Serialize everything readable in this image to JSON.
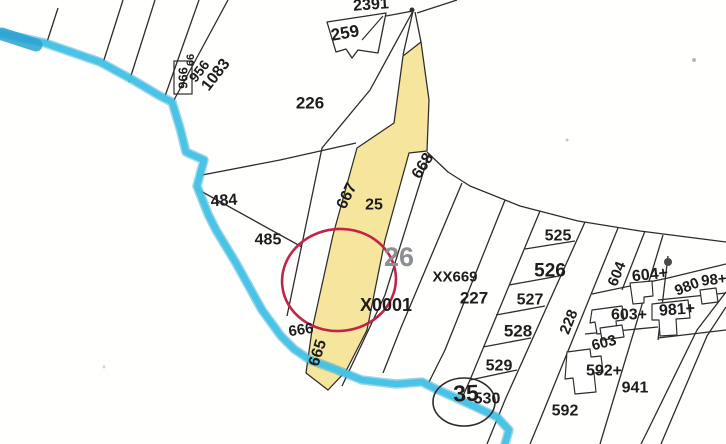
{
  "canvas": {
    "width": 726,
    "height": 444,
    "background": "#fffffe"
  },
  "colors": {
    "line": "#2e2c28",
    "text": "#1d1d1b",
    "muted": "#8d9092",
    "water": "#45c3e6",
    "water_dark": "#2aa2d0",
    "road_fill": "#f6e59d",
    "highlight": "#c02448",
    "white": "#ffffff"
  },
  "map": {
    "road_parcel": {
      "name": "road-parcel-25-highlight",
      "points": [
        [
          421,
          42
        ],
        [
          429,
          100
        ],
        [
          427,
          151
        ],
        [
          409,
          153
        ],
        [
          385,
          240
        ],
        [
          367,
          330
        ],
        [
          346,
          371
        ],
        [
          328,
          390
        ],
        [
          306,
          373
        ],
        [
          312,
          330
        ],
        [
          333,
          235
        ],
        [
          357,
          148
        ],
        [
          394,
          123
        ],
        [
          403,
          56
        ]
      ]
    },
    "flag_parcel_259": {
      "outline": [
        [
          327,
          22
        ],
        [
          386,
          13
        ],
        [
          378,
          53
        ],
        [
          358,
          50
        ],
        [
          352,
          58
        ],
        [
          346,
          49
        ],
        [
          336,
          52
        ]
      ],
      "inner_line": [
        [
          383,
          16
        ],
        [
          362,
          40
        ]
      ]
    },
    "boundaries": [
      {
        "name": "field-line-1",
        "points": [
          [
            58,
            8
          ],
          [
            47,
            42
          ]
        ]
      },
      {
        "name": "field-line-2",
        "points": [
          [
            123,
            0
          ],
          [
            103,
            63
          ]
        ]
      },
      {
        "name": "field-line-3",
        "points": [
          [
            155,
            0
          ],
          [
            129,
            82
          ]
        ]
      },
      {
        "name": "field-line-4",
        "points": [
          [
            199,
            0
          ],
          [
            164,
            99
          ]
        ]
      },
      {
        "name": "field-line-5",
        "points": [
          [
            228,
            0
          ],
          [
            174,
            100
          ]
        ]
      },
      {
        "name": "parcel-226-south-line",
        "points": [
          [
            197,
            176
          ],
          [
            280,
            160
          ],
          [
            356,
            143
          ]
        ]
      },
      {
        "name": "parcel-484-south-line",
        "points": [
          [
            197,
            189
          ],
          [
            302,
            247
          ]
        ]
      },
      {
        "name": "road-west-sliver-line",
        "points": [
          [
            413,
            11
          ],
          [
            370,
            90
          ],
          [
            322,
            148
          ],
          [
            287,
            316
          ]
        ]
      },
      {
        "name": "apex-left-line",
        "points": [
          [
            413,
            11
          ],
          [
            403,
            55
          ]
        ]
      },
      {
        "name": "apex-right-line",
        "points": [
          [
            415,
            12
          ],
          [
            421,
            42
          ]
        ]
      },
      {
        "name": "apex-northeast-line",
        "points": [
          [
            417,
            13
          ],
          [
            457,
            0
          ]
        ]
      },
      {
        "name": "apex-flag-link-line",
        "points": [
          [
            413,
            11
          ],
          [
            386,
            16
          ]
        ]
      },
      {
        "name": "sliver-668-east-line",
        "points": [
          [
            429,
            154
          ],
          [
            385,
            295
          ],
          [
            342,
            386
          ]
        ]
      },
      {
        "name": "parcel-26-east-line",
        "points": [
          [
            462,
            183
          ],
          [
            400,
            330
          ],
          [
            383,
            373
          ]
        ]
      },
      {
        "name": "parcel-xx669-east-line",
        "points": [
          [
            505,
            200
          ],
          [
            445,
            350
          ],
          [
            428,
            384
          ]
        ]
      },
      {
        "name": "parcel-227-east-line",
        "points": [
          [
            540,
            211
          ],
          [
            470,
            380
          ],
          [
            462,
            398
          ]
        ]
      },
      {
        "name": "chain-east-line",
        "points": [
          [
            585,
            222
          ],
          [
            505,
            400
          ],
          [
            487,
            444
          ]
        ]
      },
      {
        "name": "sliver-228-east-line",
        "points": [
          [
            618,
            228
          ],
          [
            540,
            420
          ],
          [
            530,
            444
          ]
        ]
      },
      {
        "name": "parcel-604-east-line",
        "points": [
          [
            645,
            231
          ],
          [
            622,
            290
          ]
        ]
      },
      {
        "name": "parcel-592-east-line",
        "points": [
          [
            663,
            235
          ],
          [
            600,
            444
          ]
        ]
      },
      {
        "name": "road-edge-line-1",
        "points": [
          [
            726,
            292
          ],
          [
            697,
            330
          ],
          [
            648,
            430
          ],
          [
            641,
            444
          ]
        ]
      },
      {
        "name": "road-edge-line-2",
        "points": [
          [
            726,
            307
          ],
          [
            707,
            336
          ],
          [
            661,
            444
          ]
        ]
      },
      {
        "name": "main-north-boundary",
        "points": [
          [
            427,
            152
          ],
          [
            448,
            172
          ],
          [
            470,
            186
          ],
          [
            520,
            206
          ],
          [
            578,
            221
          ],
          [
            640,
            231
          ],
          [
            726,
            242
          ]
        ]
      },
      {
        "name": "chain-tie-525-526",
        "points": [
          [
            525,
            249
          ],
          [
            575,
            241
          ]
        ]
      },
      {
        "name": "chain-tie-526-527",
        "points": [
          [
            509,
            285
          ],
          [
            559,
            276
          ]
        ]
      },
      {
        "name": "chain-tie-527-528",
        "points": [
          [
            496,
            315
          ],
          [
            545,
            306
          ]
        ]
      },
      {
        "name": "chain-tie-528-529",
        "points": [
          [
            483,
            347
          ],
          [
            531,
            338
          ]
        ]
      },
      {
        "name": "chain-tie-529-530",
        "points": [
          [
            470,
            380
          ],
          [
            517,
            370
          ]
        ]
      },
      {
        "name": "block-tie-604-603",
        "points": [
          [
            592,
            294
          ],
          [
            668,
            278
          ],
          [
            726,
            264
          ]
        ]
      },
      {
        "name": "block-divider-vertical",
        "points": [
          [
            668,
            256
          ],
          [
            658,
            340
          ]
        ]
      },
      {
        "name": "block-tie-603-592",
        "points": [
          [
            585,
            334
          ],
          [
            658,
            327
          ]
        ]
      },
      {
        "name": "block-tie-981-south",
        "points": [
          [
            658,
            338
          ],
          [
            726,
            330
          ]
        ]
      },
      {
        "name": "block-tie-980-981",
        "points": [
          [
            658,
            300
          ],
          [
            726,
            293
          ]
        ]
      }
    ],
    "buildings": [
      {
        "name": "building-604plus",
        "points": [
          [
            630,
            283
          ],
          [
            652,
            281
          ],
          [
            653,
            296
          ],
          [
            644,
            297
          ],
          [
            644,
            303
          ],
          [
            633,
            304
          ]
        ]
      },
      {
        "name": "building-603plus",
        "points": [
          [
            592,
            310
          ],
          [
            622,
            306
          ],
          [
            624,
            320
          ],
          [
            616,
            321
          ],
          [
            617,
            332
          ],
          [
            597,
            334
          ],
          [
            595,
            322
          ],
          [
            590,
            323
          ]
        ]
      },
      {
        "name": "building-981plus",
        "points": [
          [
            652,
            304
          ],
          [
            688,
            300
          ],
          [
            690,
            318
          ],
          [
            676,
            319
          ],
          [
            677,
            335
          ],
          [
            660,
            336
          ],
          [
            659,
            320
          ],
          [
            652,
            320
          ]
        ]
      },
      {
        "name": "building-592plus",
        "points": [
          [
            567,
            352
          ],
          [
            590,
            349
          ],
          [
            591,
            357
          ],
          [
            601,
            356
          ],
          [
            603,
            372
          ],
          [
            594,
            373
          ],
          [
            596,
            392
          ],
          [
            575,
            394
          ],
          [
            573,
            378
          ],
          [
            565,
            379
          ]
        ]
      },
      {
        "name": "building-603-rect",
        "points": [
          [
            600,
            328
          ],
          [
            622,
            325
          ],
          [
            624,
            337
          ],
          [
            602,
            340
          ]
        ]
      },
      {
        "name": "building-980-rect",
        "points": [
          [
            700,
            290
          ],
          [
            716,
            288
          ],
          [
            718,
            302
          ],
          [
            702,
            304
          ]
        ]
      }
    ],
    "waterway": {
      "name": "waterway-stream",
      "points": [
        [
          0,
          33
        ],
        [
          45,
          43
        ],
        [
          100,
          62
        ],
        [
          133,
          80
        ],
        [
          160,
          96
        ],
        [
          172,
          102
        ],
        [
          180,
          128
        ],
        [
          186,
          152
        ],
        [
          204,
          160
        ],
        [
          197,
          186
        ],
        [
          208,
          214
        ],
        [
          216,
          230
        ],
        [
          236,
          263
        ],
        [
          262,
          310
        ],
        [
          281,
          336
        ],
        [
          294,
          349
        ],
        [
          310,
          360
        ],
        [
          332,
          368
        ],
        [
          362,
          380
        ],
        [
          396,
          384
        ],
        [
          422,
          382
        ],
        [
          436,
          389
        ],
        [
          465,
          402
        ],
        [
          497,
          417
        ],
        [
          509,
          430
        ],
        [
          505,
          444
        ]
      ],
      "width": 6.5,
      "halo_width": 9.5
    },
    "waterway_source_blob": {
      "name": "waterway-source-blob",
      "points": [
        [
          2,
          34
        ],
        [
          36,
          45
        ]
      ],
      "width": 13
    },
    "label_box_966": {
      "x": 174,
      "y": 61,
      "w": 18,
      "h": 33
    },
    "circles": [
      {
        "name": "red-highlight-circle",
        "cx": 339,
        "cy": 280,
        "rx": 57,
        "ry": 51,
        "rot": -6,
        "color": "highlight",
        "width": 2.6
      },
      {
        "name": "parcel-35-circle",
        "cx": 464,
        "cy": 402,
        "rx": 31,
        "ry": 24,
        "rot": 0,
        "color": "line",
        "width": 1.6
      }
    ],
    "specks": [
      {
        "name": "apex-mark",
        "x": 412,
        "y": 10,
        "r": 2.5,
        "c": "#33312d"
      },
      {
        "name": "scan-blot",
        "x": 668,
        "y": 262,
        "r": 4,
        "c": "#4a4a46"
      },
      {
        "name": "scan-dot-1",
        "x": 567,
        "y": 140,
        "r": 1.5,
        "c": "#c9c6c0"
      },
      {
        "name": "scan-dot-2",
        "x": 694,
        "y": 60,
        "r": 2,
        "c": "#b9b6ae"
      },
      {
        "name": "scan-dot-3",
        "x": 104,
        "y": 367,
        "r": 1.5,
        "c": "#d8d5cf"
      }
    ],
    "labels": [
      {
        "text": "2391",
        "x": 371,
        "y": 5,
        "size": 16,
        "rot": -4
      },
      {
        "text": "259",
        "x": 345,
        "y": 33,
        "size": 17,
        "rot": -10
      },
      {
        "text": "226",
        "x": 310,
        "y": 103,
        "size": 17,
        "rot": 0
      },
      {
        "text": "966",
        "x": 183,
        "y": 78,
        "size": 13,
        "rot": -90
      },
      {
        "text": "66",
        "x": 191,
        "y": 60,
        "size": 11,
        "rot": -90
      },
      {
        "text": "956",
        "x": 199,
        "y": 71,
        "size": 14,
        "rot": -52
      },
      {
        "text": "1083",
        "x": 216,
        "y": 75,
        "size": 16,
        "rot": -52
      },
      {
        "text": "484",
        "x": 224,
        "y": 201,
        "size": 16,
        "rot": -4
      },
      {
        "text": "485",
        "x": 268,
        "y": 240,
        "size": 16,
        "rot": 0
      },
      {
        "text": "667",
        "x": 347,
        "y": 196,
        "size": 16,
        "rot": -64
      },
      {
        "text": "25",
        "x": 374,
        "y": 205,
        "size": 16,
        "rot": 0
      },
      {
        "text": "668",
        "x": 423,
        "y": 166,
        "size": 16,
        "rot": -58
      },
      {
        "text": "26",
        "x": 399,
        "y": 257,
        "size": 27,
        "rot": 0,
        "color": "muted"
      },
      {
        "text": "X0001",
        "x": 386,
        "y": 305,
        "size": 18,
        "rot": 0
      },
      {
        "text": "XX669",
        "x": 455,
        "y": 277,
        "size": 15,
        "rot": 0
      },
      {
        "text": "227",
        "x": 474,
        "y": 298,
        "size": 17,
        "rot": 0
      },
      {
        "text": "525",
        "x": 558,
        "y": 236,
        "size": 16,
        "rot": 0
      },
      {
        "text": "526",
        "x": 550,
        "y": 271,
        "size": 19,
        "rot": 0
      },
      {
        "text": "527",
        "x": 530,
        "y": 300,
        "size": 16,
        "rot": 0
      },
      {
        "text": "528",
        "x": 518,
        "y": 331,
        "size": 17,
        "rot": 0
      },
      {
        "text": "529",
        "x": 499,
        "y": 366,
        "size": 16,
        "rot": 0
      },
      {
        "text": "530",
        "x": 487,
        "y": 399,
        "size": 16,
        "rot": 0
      },
      {
        "text": "35",
        "x": 466,
        "y": 393,
        "size": 23,
        "rot": -2,
        "weight": 700
      },
      {
        "text": "592",
        "x": 565,
        "y": 411,
        "size": 16,
        "rot": 0
      },
      {
        "text": "592+",
        "x": 604,
        "y": 371,
        "size": 16,
        "rot": 0
      },
      {
        "text": "603",
        "x": 604,
        "y": 343,
        "size": 15,
        "rot": -14
      },
      {
        "text": "603+",
        "x": 629,
        "y": 315,
        "size": 16,
        "rot": 0
      },
      {
        "text": "604",
        "x": 617,
        "y": 274,
        "size": 15,
        "rot": -68
      },
      {
        "text": "604+",
        "x": 650,
        "y": 275,
        "size": 16,
        "rot": -6
      },
      {
        "text": "980",
        "x": 687,
        "y": 287,
        "size": 15,
        "rot": -22
      },
      {
        "text": "98+",
        "x": 714,
        "y": 280,
        "size": 15,
        "rot": -6
      },
      {
        "text": "981+",
        "x": 677,
        "y": 310,
        "size": 16,
        "rot": -4
      },
      {
        "text": "941",
        "x": 635,
        "y": 388,
        "size": 16,
        "rot": 0
      },
      {
        "text": "665",
        "x": 318,
        "y": 353,
        "size": 16,
        "rot": -72
      },
      {
        "text": "666",
        "x": 301,
        "y": 330,
        "size": 15,
        "rot": -8
      },
      {
        "text": "228",
        "x": 569,
        "y": 322,
        "size": 15,
        "rot": -68
      }
    ]
  }
}
